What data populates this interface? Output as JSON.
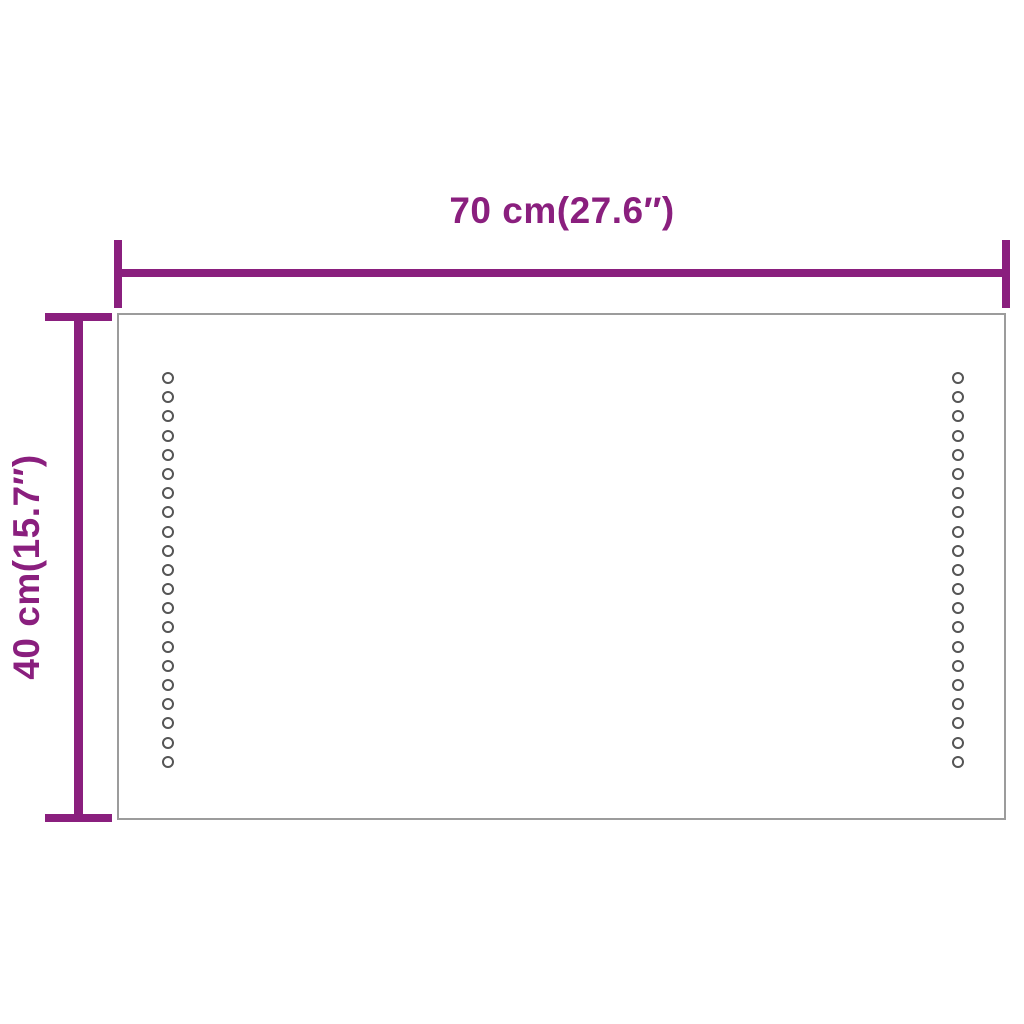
{
  "diagram": {
    "kind": "product-dimension-diagram",
    "dimension_labels": {
      "width": "70 cm(27.6″)",
      "height": "40 cm(15.7″)"
    },
    "led_dots": {
      "columns": 2,
      "dots_per_column": 21
    },
    "colors": {
      "dimension_annotation": "#8a1f7e",
      "mirror_border": "#9c9c9c",
      "led_dot_outline": "#555555",
      "background": "#ffffff"
    }
  }
}
